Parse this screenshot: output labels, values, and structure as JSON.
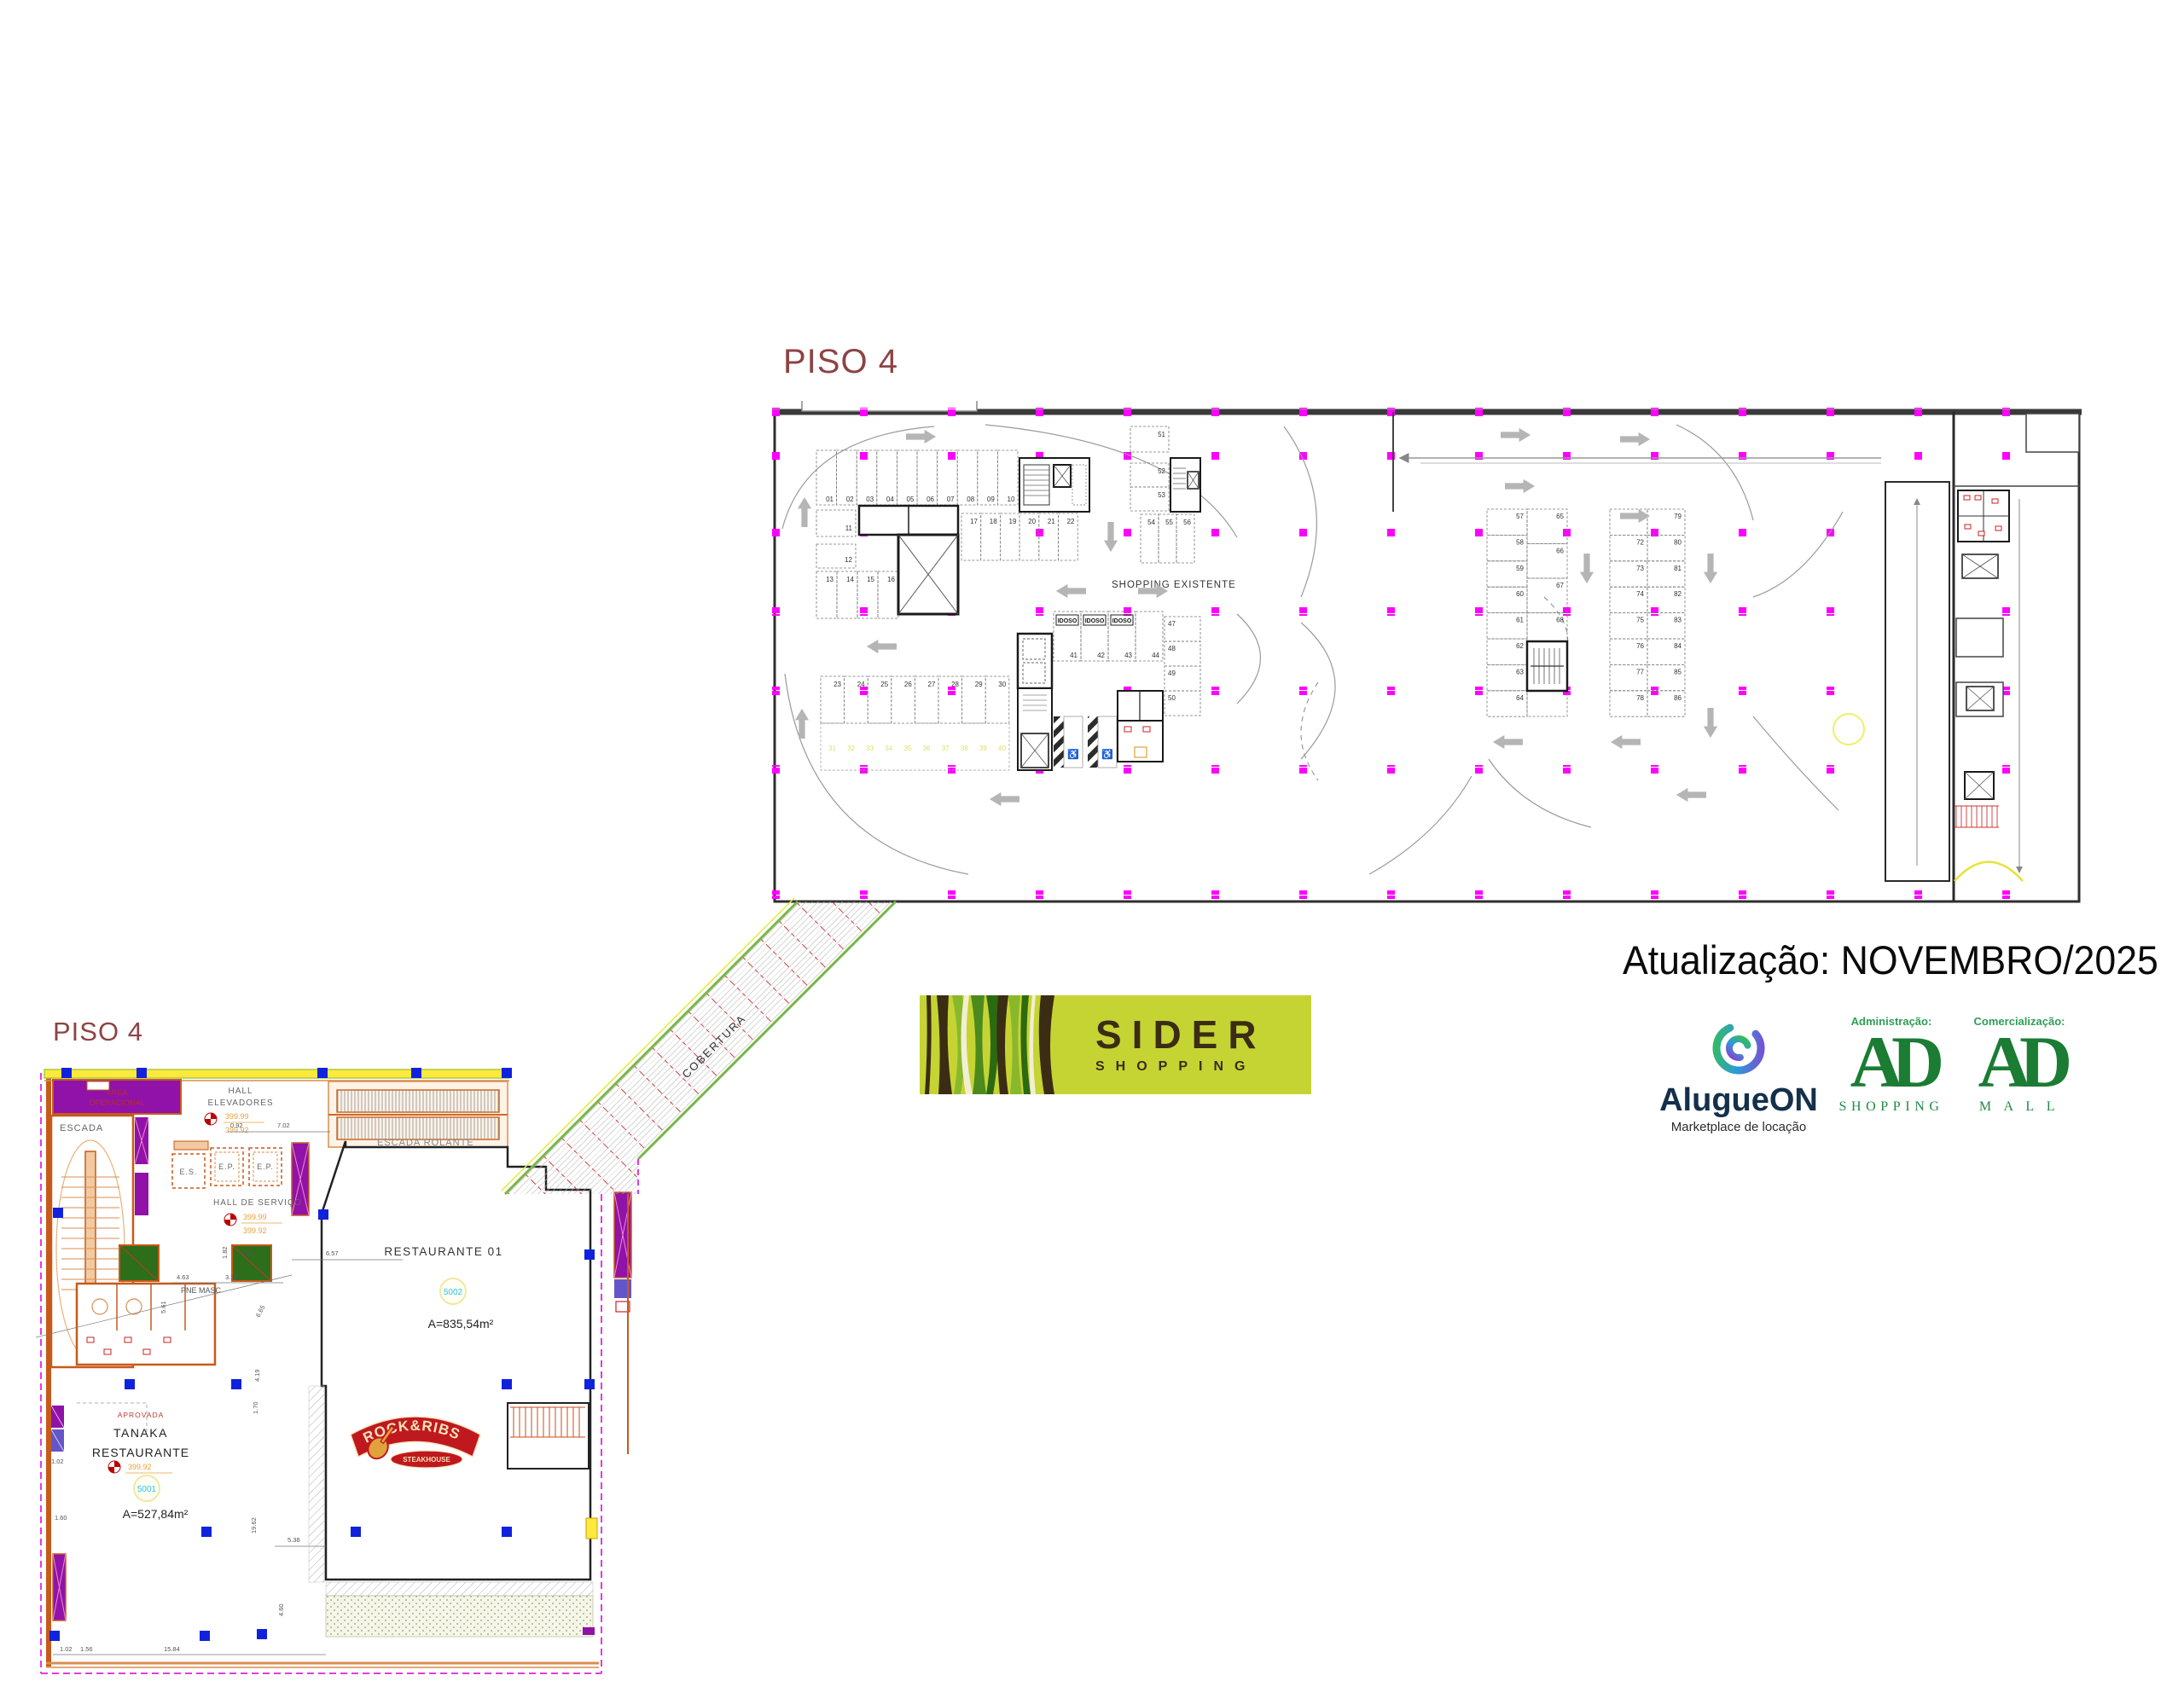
{
  "plan_top": {
    "title": "PISO 4",
    "shopping_existente": "SHOPPING EXISTENTE",
    "stalls": {
      "row_01_10": [
        "01",
        "02",
        "03",
        "04",
        "05",
        "06",
        "07",
        "08",
        "09",
        "10"
      ],
      "s11": "11",
      "s12": "12",
      "row_13_16": [
        "13",
        "14",
        "15",
        "16"
      ],
      "row_17_22": [
        "17",
        "18",
        "19",
        "20",
        "21",
        "22"
      ],
      "row_23_30": [
        "23",
        "24",
        "25",
        "26",
        "27",
        "28",
        "29",
        "30"
      ],
      "row_31_40": [
        "31",
        "32",
        "33",
        "34",
        "35",
        "36",
        "37",
        "38",
        "39",
        "40"
      ],
      "idoso_numbers": [
        "41",
        "42",
        "43",
        "44"
      ],
      "idoso_labels": [
        "IDOSO",
        "IDOSO",
        "IDOSO"
      ],
      "col_47_50": [
        "47",
        "48",
        "49",
        "50"
      ],
      "s51": "51",
      "col_52_53": [
        "52",
        "53"
      ],
      "row_54_56": [
        "54",
        "55",
        "56"
      ],
      "col_57_64": [
        "57",
        "58",
        "59",
        "60",
        "61",
        "62",
        "63",
        "64"
      ],
      "col_65_70": [
        "65",
        "66",
        "67",
        "68",
        "69",
        "70"
      ],
      "col_71_78": [
        "71",
        "72",
        "73",
        "74",
        "75",
        "76",
        "77",
        "78"
      ],
      "col_79_86": [
        "79",
        "80",
        "81",
        "82",
        "83",
        "84",
        "85",
        "86"
      ]
    }
  },
  "corridor": {
    "label": "COBERTURA"
  },
  "plan_bottom": {
    "title": "PISO 4",
    "labels": {
      "area_operacional_1": "ÁREA",
      "area_operacional_2": "OPERACIONAL",
      "escada": "ESCADA",
      "hall_1": "HALL",
      "hall_2": "ELEVADORES",
      "hall_servico": "HALL DE SERVIÇO",
      "es": "E.S.",
      "ep1": "E.P.",
      "ep2": "E.P.",
      "pne_masc": "PNE MASC",
      "escada_rolante": "ESCADA ROLANTE",
      "aprovada": "APROVADA",
      "tanaka_1": "TANAKA",
      "tanaka_2": "RESTAURANTE",
      "restaurante01": "RESTAURANTE 01",
      "level_top": "399.99",
      "level_bottom": "399.92",
      "unit_5001": "5001",
      "unit_5002": "5002",
      "area_5001": "A=527,84m²",
      "area_5002": "A=835,54m²"
    },
    "rockribs": {
      "line1": "ROCK&RIBS",
      "line2": "STEAKHOUSE"
    },
    "dims": {
      "d092a": "0.92",
      "d702": "7.02",
      "d657": "6.57",
      "d182": "1.82",
      "d092b": "0.92",
      "d463": "4.63",
      "d330": "3.30",
      "d561": "5.61",
      "d665": "6.65",
      "d419": "4.19",
      "d170": "1.70",
      "d102a": "1.02",
      "d160": "1.60",
      "d102b": "1.02",
      "d156": "1.56",
      "d1584": "15.84",
      "d1962": "19.62",
      "d538": "5.38",
      "d460": "4.60"
    }
  },
  "branding": {
    "update_text": "Atualização: NOVEMBRO/2025",
    "sider": {
      "name": "SIDER",
      "sub": "SHOPPING"
    },
    "alugueon": {
      "name": "AlugueON",
      "tagline": "Marketplace de locação"
    },
    "ad_shopping": {
      "header": "Administração:",
      "logo": "AD",
      "sub": "SHOPPING"
    },
    "ad_mall": {
      "header": "Comercialização:",
      "logo": "AD",
      "sub": "M A L L"
    }
  }
}
